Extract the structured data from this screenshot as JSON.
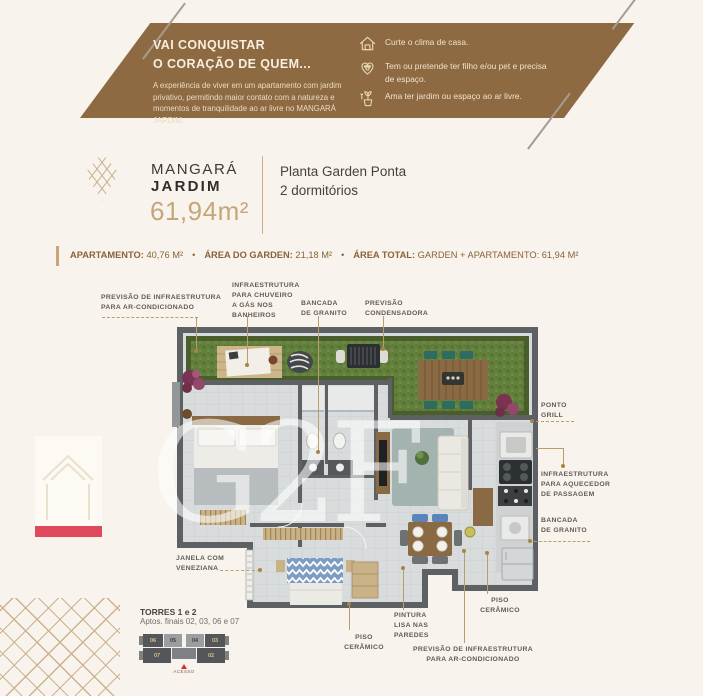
{
  "colors": {
    "background": "#f8f3ec",
    "banner_brown": "#8d6a42",
    "accent_gold": "#c5a679",
    "stats_brown": "#8a6239",
    "label_gray": "#625b52",
    "watermark_red": "#e0485c",
    "garden_green": "#63803c"
  },
  "banner": {
    "heading": "VAI CONQUISTAR\nO CORAÇÃO DE QUEM...",
    "body": "A experiência de viver em um apartamento com jardim privativo, permitindo maior contato com a natureza e momentos de tranquilidade ao ar livre no MANGARÁ JARDIM.",
    "items": [
      {
        "icon": "house-icon",
        "text": "Curte o clima de casa."
      },
      {
        "icon": "pet-heart-icon",
        "text": "Tem ou pretende ter filho e/ou pet e precisa de espaço."
      },
      {
        "icon": "plant-icon",
        "text": "Ama ter jardim ou espaço ao ar livre."
      }
    ]
  },
  "brand": {
    "name_top": "MANGARÁ",
    "name_bottom": "JARDIM",
    "area": "61,94m²"
  },
  "plan_title": "Planta Garden Ponta\n2 dormitórios",
  "stats": {
    "bullet": "•",
    "items": [
      {
        "label": "APARTAMENTO:",
        "value": "40,76 M²"
      },
      {
        "label": "ÁREA DO GARDEN:",
        "value": "21,18 M²"
      },
      {
        "label": "ÁREA TOTAL:",
        "value": "GARDEN + APARTAMENTO: 61,94 M²"
      }
    ]
  },
  "callouts": {
    "ac_top": "PREVISÃO DE INFRAESTRUTURA\nPARA AR-CONDICIONADO",
    "shower_gas": "INFRAESTRUTURA\nPARA CHUVEIRO\nA GÁS NOS\nBANHEIROS",
    "granite_top": "BANCADA\nDE GRANITO",
    "condenser": "PREVISÃO\nCONDENSADORA",
    "grill": "PONTO\nGRILL",
    "water_heater": "INFRAESTRUTURA\nPARA AQUECEDOR\nDE PASSAGEM",
    "granite_right": "BANCADA\nDE GRANITO",
    "window_blinds": "JANELA COM\nVENEZIANA",
    "ceramic_floor_center": "PISO\nCERÂMICO",
    "smooth_paint": "PINTURA\nLISA NAS\nPAREDES",
    "ceramic_floor_right": "PISO\nCERÂMICO",
    "ac_bottom": "PREVISÃO DE INFRAESTRUTURA\nPARA AR-CONDICIONADO"
  },
  "keyplan": {
    "title": "TORRES 1 e 2",
    "subtitle": "Aptos. finais 02, 03, 06 e 07",
    "units_top": [
      "06",
      "05",
      "04",
      "03"
    ],
    "unit_bottom_left": "07",
    "unit_bottom_right": "02",
    "access": "ACESSO"
  },
  "watermark": {
    "letters": "G2F"
  }
}
